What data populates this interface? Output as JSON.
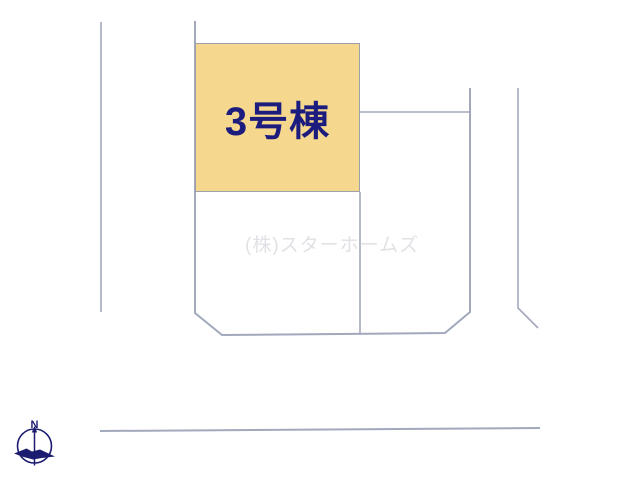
{
  "site_plan": {
    "building": {
      "label": "3号棟",
      "fill_color": "#f6d78e",
      "label_color": "#1c1c7e"
    },
    "watermark": "(株)スターホームズ",
    "compass": {
      "north_label": "N",
      "color": "#1b1b70"
    },
    "boundary_line_color": "#a2a9bd"
  }
}
